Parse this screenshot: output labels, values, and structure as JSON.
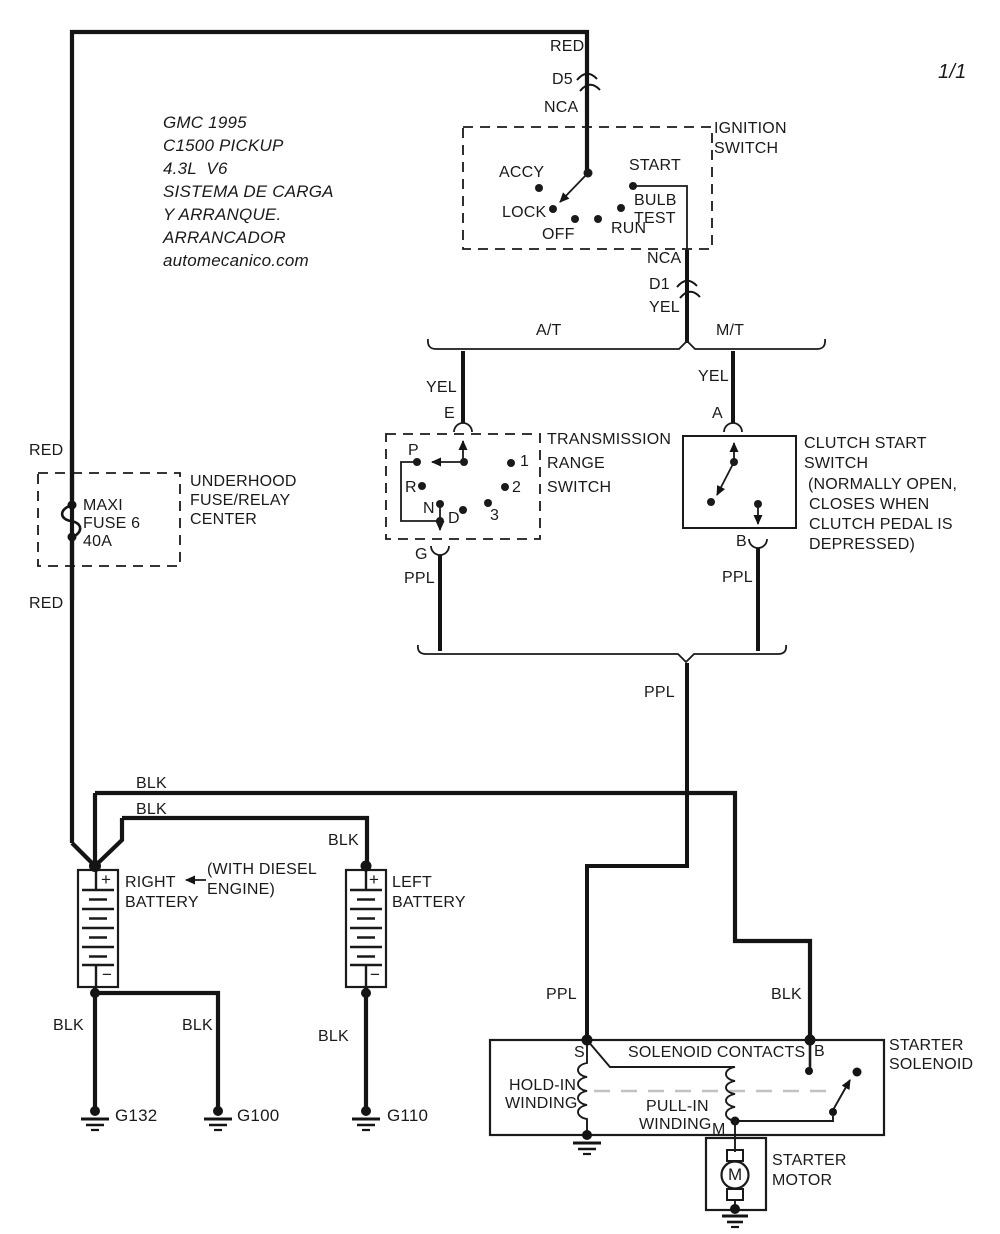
{
  "diagram": {
    "page_number": "1/1",
    "colors": {
      "ink": "#1a1a1a",
      "wire": "#141414",
      "mech_link_dash": "#c2c2c2",
      "background": "#ffffff"
    },
    "title_block": [
      "GMC 1995",
      "C1500 PICKUP",
      "4.3L  V6",
      "SISTEMA DE CARGA",
      "Y ARRANQUE.",
      "ARRANCADOR",
      "automecanico.com"
    ],
    "components": {
      "ignition_switch": "IGNITION SWITCH",
      "transmission_range_switch": "TRANSMISSION RANGE SWITCH",
      "clutch_start_switch": "CLUTCH START SWITCH (NORMALLY OPEN, CLOSES WHEN CLUTCH PEDAL IS DEPRESSED)",
      "underhood_fuse_relay_center": "UNDERHOOD FUSE/RELAY CENTER",
      "maxi_fuse": "MAXI FUSE 6 40A",
      "right_battery": "RIGHT BATTERY",
      "left_battery": "LEFT BATTERY",
      "starter_solenoid": "STARTER SOLENOID",
      "starter_motor": "STARTER MOTOR",
      "grounds": [
        "G132",
        "G100",
        "G110"
      ]
    },
    "labels": [
      {
        "name": "page-number",
        "text": "1/1",
        "x": 938,
        "y": 62,
        "size": 20,
        "it": true
      },
      {
        "name": "title-line-1",
        "text": "GMC 1995",
        "x": 163,
        "y": 114,
        "size": 17,
        "it": true
      },
      {
        "name": "title-line-2",
        "text": "C1500 PICKUP",
        "x": 163,
        "y": 137,
        "size": 17,
        "it": true
      },
      {
        "name": "title-line-3",
        "text": "4.3L  V6",
        "x": 163,
        "y": 160,
        "size": 17,
        "it": true
      },
      {
        "name": "title-line-4",
        "text": "SISTEMA DE CARGA",
        "x": 163,
        "y": 183,
        "size": 17,
        "it": true
      },
      {
        "name": "title-line-5",
        "text": "Y ARRANQUE.",
        "x": 163,
        "y": 206,
        "size": 17,
        "it": true
      },
      {
        "name": "title-line-6",
        "text": "ARRANCADOR",
        "x": 163,
        "y": 229,
        "size": 17,
        "it": true
      },
      {
        "name": "title-line-7",
        "text": "automecanico.com",
        "x": 163,
        "y": 252,
        "size": 17,
        "it": true
      },
      {
        "name": "wire-label-red-top",
        "text": "RED",
        "x": 550,
        "y": 38,
        "size": 16
      },
      {
        "name": "connector-label-d5",
        "text": "D5",
        "x": 552,
        "y": 71,
        "size": 16
      },
      {
        "name": "wire-label-nca-top",
        "text": "NCA",
        "x": 544,
        "y": 99,
        "size": 16
      },
      {
        "name": "ignition-switch-label-1",
        "text": "IGNITION",
        "x": 714,
        "y": 120,
        "size": 16
      },
      {
        "name": "ignition-switch-label-2",
        "text": "SWITCH",
        "x": 714,
        "y": 140,
        "size": 16
      },
      {
        "name": "ignition-pos-accy",
        "text": "ACCY",
        "x": 499,
        "y": 164,
        "size": 16
      },
      {
        "name": "ignition-pos-start",
        "text": "START",
        "x": 629,
        "y": 157,
        "size": 16
      },
      {
        "name": "ignition-pos-lock",
        "text": "LOCK",
        "x": 502,
        "y": 204,
        "size": 16
      },
      {
        "name": "ignition-pos-bulb",
        "text": "BULB",
        "x": 634,
        "y": 192,
        "size": 16
      },
      {
        "name": "ignition-pos-test",
        "text": "TEST",
        "x": 634,
        "y": 210,
        "size": 16
      },
      {
        "name": "ignition-pos-off",
        "text": "OFF",
        "x": 542,
        "y": 226,
        "size": 16
      },
      {
        "name": "ignition-pos-run",
        "text": "RUN",
        "x": 611,
        "y": 220,
        "size": 16
      },
      {
        "name": "wire-label-nca-mid",
        "text": "NCA",
        "x": 647,
        "y": 250,
        "size": 16
      },
      {
        "name": "connector-label-d1",
        "text": "D1",
        "x": 649,
        "y": 276,
        "size": 16
      },
      {
        "name": "wire-label-yel-mid",
        "text": "YEL",
        "x": 649,
        "y": 299,
        "size": 16
      },
      {
        "name": "branch-label-at",
        "text": "A/T",
        "x": 536,
        "y": 322,
        "size": 16
      },
      {
        "name": "branch-label-mt",
        "text": "M/T",
        "x": 716,
        "y": 322,
        "size": 16
      },
      {
        "name": "wire-label-yel-left",
        "text": "YEL",
        "x": 426,
        "y": 379,
        "size": 16
      },
      {
        "name": "terminal-label-e",
        "text": "E",
        "x": 444,
        "y": 405,
        "size": 16
      },
      {
        "name": "wire-label-yel-right",
        "text": "YEL",
        "x": 698,
        "y": 368,
        "size": 16
      },
      {
        "name": "terminal-label-a",
        "text": "A",
        "x": 712,
        "y": 405,
        "size": 16
      },
      {
        "name": "trans-switch-label-1",
        "text": "TRANSMISSION",
        "x": 547,
        "y": 431,
        "size": 16
      },
      {
        "name": "trans-switch-label-2",
        "text": "RANGE",
        "x": 547,
        "y": 455,
        "size": 16
      },
      {
        "name": "trans-switch-label-3",
        "text": "SWITCH",
        "x": 547,
        "y": 479,
        "size": 16
      },
      {
        "name": "gear-label-p",
        "text": "P",
        "x": 408,
        "y": 442,
        "size": 16
      },
      {
        "name": "gear-label-1",
        "text": "1",
        "x": 520,
        "y": 453,
        "size": 16
      },
      {
        "name": "gear-label-r",
        "text": "R",
        "x": 405,
        "y": 479,
        "size": 16
      },
      {
        "name": "gear-label-2",
        "text": "2",
        "x": 512,
        "y": 479,
        "size": 16
      },
      {
        "name": "gear-label-n",
        "text": "N",
        "x": 423,
        "y": 500,
        "size": 16
      },
      {
        "name": "gear-label-d",
        "text": "D",
        "x": 448,
        "y": 510,
        "size": 16
      },
      {
        "name": "gear-label-3",
        "text": "3",
        "x": 490,
        "y": 507,
        "size": 16
      },
      {
        "name": "terminal-label-g",
        "text": "G",
        "x": 415,
        "y": 546,
        "size": 16
      },
      {
        "name": "wire-label-ppl-left",
        "text": "PPL",
        "x": 404,
        "y": 570,
        "size": 16
      },
      {
        "name": "clutch-switch-label-1",
        "text": "CLUTCH START",
        "x": 804,
        "y": 435,
        "size": 16
      },
      {
        "name": "clutch-switch-label-2",
        "text": "SWITCH",
        "x": 804,
        "y": 455,
        "size": 16
      },
      {
        "name": "clutch-switch-label-3",
        "text": "(NORMALLY OPEN,",
        "x": 808,
        "y": 476,
        "size": 16
      },
      {
        "name": "clutch-switch-label-4",
        "text": "CLOSES WHEN",
        "x": 809,
        "y": 496,
        "size": 16
      },
      {
        "name": "clutch-switch-label-5",
        "text": "CLUTCH PEDAL IS",
        "x": 809,
        "y": 516,
        "size": 16
      },
      {
        "name": "clutch-switch-label-6",
        "text": "DEPRESSED)",
        "x": 809,
        "y": 536,
        "size": 16
      },
      {
        "name": "terminal-label-b-clutch",
        "text": "B",
        "x": 736,
        "y": 533,
        "size": 16
      },
      {
        "name": "wire-label-ppl-right",
        "text": "PPL",
        "x": 722,
        "y": 569,
        "size": 16
      },
      {
        "name": "wire-label-ppl-center",
        "text": "PPL",
        "x": 644,
        "y": 684,
        "size": 16
      },
      {
        "name": "wire-label-red-1",
        "text": "RED",
        "x": 29,
        "y": 442,
        "size": 16
      },
      {
        "name": "fuse-center-label-1",
        "text": "UNDERHOOD",
        "x": 190,
        "y": 473,
        "size": 16
      },
      {
        "name": "fuse-center-label-2",
        "text": "FUSE/RELAY",
        "x": 190,
        "y": 492,
        "size": 16
      },
      {
        "name": "fuse-center-label-3",
        "text": "CENTER",
        "x": 190,
        "y": 511,
        "size": 16
      },
      {
        "name": "maxi-fuse-label-1",
        "text": "MAXI",
        "x": 83,
        "y": 497,
        "size": 16
      },
      {
        "name": "maxi-fuse-label-2",
        "text": "FUSE 6",
        "x": 83,
        "y": 515,
        "size": 16
      },
      {
        "name": "maxi-fuse-label-3",
        "text": "40A",
        "x": 83,
        "y": 533,
        "size": 16
      },
      {
        "name": "wire-label-red-2",
        "text": "RED",
        "x": 29,
        "y": 595,
        "size": 16
      },
      {
        "name": "wire-label-blk-1",
        "text": "BLK",
        "x": 136,
        "y": 775,
        "size": 16
      },
      {
        "name": "wire-label-blk-2",
        "text": "BLK",
        "x": 136,
        "y": 801,
        "size": 16
      },
      {
        "name": "wire-label-blk-3",
        "text": "BLK",
        "x": 328,
        "y": 832,
        "size": 16
      },
      {
        "name": "right-battery-label-1",
        "text": "RIGHT",
        "x": 125,
        "y": 874,
        "size": 16
      },
      {
        "name": "right-battery-label-2",
        "text": "BATTERY",
        "x": 125,
        "y": 894,
        "size": 16
      },
      {
        "name": "diesel-note-label-1",
        "text": "(WITH DIESEL",
        "x": 207,
        "y": 861,
        "size": 16
      },
      {
        "name": "diesel-note-label-2",
        "text": "ENGINE)",
        "x": 207,
        "y": 881,
        "size": 16
      },
      {
        "name": "left-battery-label-1",
        "text": "LEFT",
        "x": 392,
        "y": 874,
        "size": 16
      },
      {
        "name": "left-battery-label-2",
        "text": "BATTERY",
        "x": 392,
        "y": 894,
        "size": 16
      },
      {
        "name": "right-battery-plus",
        "text": "+",
        "x": 101,
        "y": 871,
        "size": 17
      },
      {
        "name": "right-battery-minus",
        "text": "−",
        "x": 102,
        "y": 966,
        "size": 17
      },
      {
        "name": "left-battery-plus",
        "text": "+",
        "x": 369,
        "y": 871,
        "size": 17
      },
      {
        "name": "left-battery-minus",
        "text": "−",
        "x": 370,
        "y": 966,
        "size": 17
      },
      {
        "name": "wire-label-blk-g132",
        "text": "BLK",
        "x": 53,
        "y": 1017,
        "size": 16
      },
      {
        "name": "wire-label-blk-g100",
        "text": "BLK",
        "x": 182,
        "y": 1017,
        "size": 16
      },
      {
        "name": "wire-label-blk-g110",
        "text": "BLK",
        "x": 318,
        "y": 1028,
        "size": 16
      },
      {
        "name": "ground-label-g132",
        "text": "G132",
        "x": 115,
        "y": 1107,
        "size": 17
      },
      {
        "name": "ground-label-g100",
        "text": "G100",
        "x": 237,
        "y": 1107,
        "size": 17
      },
      {
        "name": "ground-label-g110",
        "text": "G110",
        "x": 387,
        "y": 1107,
        "size": 17
      },
      {
        "name": "wire-label-ppl-s",
        "text": "PPL",
        "x": 546,
        "y": 986,
        "size": 16
      },
      {
        "name": "wire-label-blk-b",
        "text": "BLK",
        "x": 771,
        "y": 986,
        "size": 16
      },
      {
        "name": "terminal-label-s",
        "text": "S",
        "x": 574,
        "y": 1044,
        "size": 16
      },
      {
        "name": "terminal-label-b-sol",
        "text": "B",
        "x": 814,
        "y": 1043,
        "size": 16
      },
      {
        "name": "solenoid-contacts-label",
        "text": "SOLENOID CONTACTS",
        "x": 628,
        "y": 1044,
        "size": 16
      },
      {
        "name": "starter-solenoid-label-1",
        "text": "STARTER",
        "x": 889,
        "y": 1037,
        "size": 16
      },
      {
        "name": "starter-solenoid-label-2",
        "text": "SOLENOID",
        "x": 889,
        "y": 1056,
        "size": 16
      },
      {
        "name": "hold-in-winding-label-1",
        "text": "HOLD-IN",
        "x": 509,
        "y": 1077,
        "size": 16
      },
      {
        "name": "hold-in-winding-label-2",
        "text": "WINDING",
        "x": 505,
        "y": 1095,
        "size": 16
      },
      {
        "name": "pull-in-winding-label-1",
        "text": "PULL-IN",
        "x": 646,
        "y": 1098,
        "size": 16
      },
      {
        "name": "pull-in-winding-label-2",
        "text": "WINDING",
        "x": 639,
        "y": 1116,
        "size": 16
      },
      {
        "name": "terminal-label-m",
        "text": "M",
        "x": 712,
        "y": 1121,
        "size": 16
      },
      {
        "name": "starter-motor-label-1",
        "text": "STARTER",
        "x": 772,
        "y": 1152,
        "size": 16
      },
      {
        "name": "starter-motor-label-2",
        "text": "MOTOR",
        "x": 772,
        "y": 1172,
        "size": 16
      },
      {
        "name": "motor-symbol-m",
        "text": "M",
        "x": 728,
        "y": 1166,
        "size": 17
      }
    ]
  }
}
